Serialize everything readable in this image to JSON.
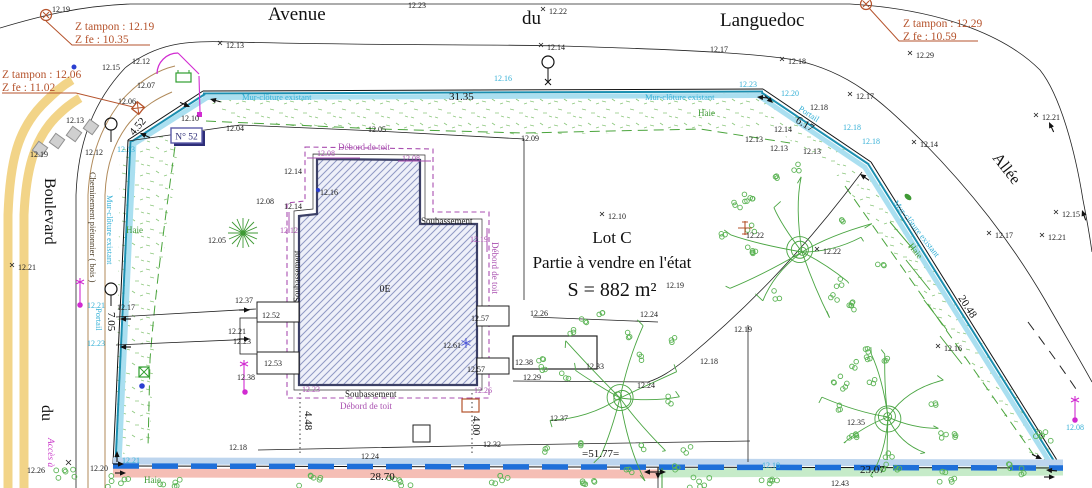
{
  "streets": {
    "avenue_w1": "Avenue",
    "avenue_w2": "du",
    "avenue_w3": "Languedoc",
    "boulevard_w1": "Boulevard",
    "boulevard_w2": "du",
    "allee": "Allée"
  },
  "lot": {
    "name": "Lot C",
    "desc": "Partie à vendre en l'état",
    "area": "S = 882 m²",
    "house_number": "N° 52",
    "floor": "0E"
  },
  "zbox": {
    "z1_l1": "Z tampon : 12.19",
    "z1_l2": "Z fe : 10.35",
    "z2_l1": "Z tampon : 12.06",
    "z2_l2": "Z fe : 11.02",
    "z3_l1": "Z tampon : 12.29",
    "z3_l2": "Z fe : 10.59"
  },
  "labels": {
    "mur": "Mur-clôture existant",
    "haie": "Haie",
    "portail": "Portail",
    "chemin": "Cheminement piétonnier ( bois )",
    "acces": "Accès à",
    "soubassement": "Soubassement",
    "debord": "Débord de toit"
  },
  "colors": {
    "rust": "#b5532c",
    "cyan_text": "#35b0d6",
    "wall_band": "#aadff0",
    "wall_edge": "#1b8fb0",
    "purple": "#a94fb0",
    "green": "#3f9a35",
    "tree_green": "#4aa542",
    "blue_dash": "#1e6fd9",
    "pink_band": "#f5beb5",
    "lightblue_band": "#bdd5ee",
    "green_band": "#c6ebc9",
    "yellow": "#f2d488",
    "magenta": "#d12bd1",
    "navy": "#2e2e78"
  },
  "points": [
    {
      "x": 52,
      "y": 12,
      "v": "12.19"
    },
    {
      "x": 408,
      "y": 8,
      "v": "12.23"
    },
    {
      "x": 549,
      "y": 14,
      "v": "12.22",
      "m": 1
    },
    {
      "x": 226,
      "y": 48,
      "v": "12.13",
      "m": 1
    },
    {
      "x": 547,
      "y": 50,
      "v": "12.14",
      "m": 1
    },
    {
      "x": 788,
      "y": 64,
      "v": "12.18",
      "m": 1
    },
    {
      "x": 856,
      "y": 99,
      "v": "12.17",
      "m": 1
    },
    {
      "x": 916,
      "y": 58,
      "v": "12.29",
      "m": 1
    },
    {
      "x": 710,
      "y": 52,
      "v": "12.17"
    },
    {
      "x": 1042,
      "y": 120,
      "v": "12.21",
      "m": 1
    },
    {
      "x": 1062,
      "y": 217,
      "v": "12.15",
      "m": 1
    },
    {
      "x": 995,
      "y": 238,
      "v": "12.17",
      "m": 1
    },
    {
      "x": 1048,
      "y": 240,
      "v": "12.21",
      "m": 1
    },
    {
      "x": 920,
      "y": 147,
      "v": "12.14",
      "m": 1
    },
    {
      "x": 102,
      "y": 70,
      "v": "12.15"
    },
    {
      "x": 132,
      "y": 64,
      "v": "12.12"
    },
    {
      "x": 137,
      "y": 88,
      "v": "12.07"
    },
    {
      "x": 118,
      "y": 104,
      "v": "12.06"
    },
    {
      "x": 66,
      "y": 123,
      "v": "12.13"
    },
    {
      "x": 30,
      "y": 157,
      "v": "12.19"
    },
    {
      "x": 85,
      "y": 155,
      "v": "12.12"
    },
    {
      "x": 226,
      "y": 131,
      "v": "12.04"
    },
    {
      "x": 181,
      "y": 121,
      "v": "12.10"
    },
    {
      "x": 368,
      "y": 132,
      "v": "12.05"
    },
    {
      "x": 521,
      "y": 141,
      "v": "12.09"
    },
    {
      "x": 608,
      "y": 219,
      "v": "12.10",
      "m": 1
    },
    {
      "x": 256,
      "y": 204,
      "v": "12.08"
    },
    {
      "x": 284,
      "y": 174,
      "v": "12.14"
    },
    {
      "x": 284,
      "y": 209,
      "v": "12.14"
    },
    {
      "x": 320,
      "y": 195,
      "v": "12.16"
    },
    {
      "x": 208,
      "y": 243,
      "v": "12.05"
    },
    {
      "x": 18,
      "y": 270,
      "v": "12.21",
      "m": 1
    },
    {
      "x": 117,
      "y": 310,
      "v": "12.17"
    },
    {
      "x": 235,
      "y": 303,
      "v": "12.37"
    },
    {
      "x": 262,
      "y": 318,
      "v": "12.52"
    },
    {
      "x": 228,
      "y": 334,
      "v": "12.21"
    },
    {
      "x": 233,
      "y": 344,
      "v": "12.23"
    },
    {
      "x": 264,
      "y": 366,
      "v": "12.53"
    },
    {
      "x": 237,
      "y": 380,
      "v": "12.38"
    },
    {
      "x": 666,
      "y": 288,
      "v": "12.19"
    },
    {
      "x": 530,
      "y": 316,
      "v": "12.26"
    },
    {
      "x": 640,
      "y": 317,
      "v": "12.24"
    },
    {
      "x": 515,
      "y": 365,
      "v": "12.38"
    },
    {
      "x": 586,
      "y": 369,
      "v": "12.33"
    },
    {
      "x": 523,
      "y": 380,
      "v": "12.29"
    },
    {
      "x": 700,
      "y": 364,
      "v": "12.18"
    },
    {
      "x": 637,
      "y": 388,
      "v": "12.24"
    },
    {
      "x": 550,
      "y": 421,
      "v": "12.37"
    },
    {
      "x": 734,
      "y": 332,
      "v": "12.19"
    },
    {
      "x": 746,
      "y": 238,
      "v": "12.22"
    },
    {
      "x": 823,
      "y": 254,
      "v": "12.22",
      "m": 1
    },
    {
      "x": 847,
      "y": 425,
      "v": "12.35"
    },
    {
      "x": 944,
      "y": 351,
      "v": "12.16",
      "m": 1
    },
    {
      "x": 483,
      "y": 447,
      "v": "12.32"
    },
    {
      "x": 361,
      "y": 459,
      "v": "12.24"
    },
    {
      "x": 229,
      "y": 450,
      "v": "12.18"
    },
    {
      "x": 831,
      "y": 486,
      "v": "12.43"
    },
    {
      "x": 443,
      "y": 348,
      "v": "12.61"
    },
    {
      "x": 471,
      "y": 321,
      "v": "12.57"
    },
    {
      "x": 467,
      "y": 372,
      "v": "12.57"
    },
    {
      "x": 90,
      "y": 471,
      "v": "12.20"
    },
    {
      "x": 27,
      "y": 473,
      "v": "12.26"
    },
    {
      "x": 745,
      "y": 142,
      "v": "12.13"
    },
    {
      "x": 770,
      "y": 151,
      "v": "12.13"
    },
    {
      "x": 803,
      "y": 154,
      "v": "12.13"
    },
    {
      "x": 774,
      "y": 132,
      "v": "12.14"
    },
    {
      "x": 810,
      "y": 110,
      "v": "12.18"
    },
    {
      "x": 494,
      "y": 81,
      "v": "12.16",
      "c": "c"
    },
    {
      "x": 739,
      "y": 87,
      "v": "12.23",
      "c": "c"
    },
    {
      "x": 781,
      "y": 96,
      "v": "12.20",
      "c": "c"
    },
    {
      "x": 843,
      "y": 130,
      "v": "12.18",
      "c": "c"
    },
    {
      "x": 862,
      "y": 144,
      "v": "12.18",
      "c": "c"
    },
    {
      "x": 117,
      "y": 152,
      "v": "12.13",
      "c": "c"
    },
    {
      "x": 87,
      "y": 308,
      "v": "12.21",
      "c": "c"
    },
    {
      "x": 87,
      "y": 346,
      "v": "12.23",
      "c": "c"
    },
    {
      "x": 122,
      "y": 463,
      "v": "12.21",
      "c": "c"
    },
    {
      "x": 762,
      "y": 468,
      "v": "12.18",
      "c": "c"
    },
    {
      "x": 1066,
      "y": 430,
      "v": "12.08",
      "c": "c"
    },
    {
      "x": 317,
      "y": 156,
      "v": "12.08",
      "c": "p"
    },
    {
      "x": 402,
      "y": 161,
      "v": "12.08",
      "c": "p"
    },
    {
      "x": 280,
      "y": 233,
      "v": "12.12",
      "c": "p"
    },
    {
      "x": 470,
      "y": 242,
      "v": "12.19",
      "c": "p"
    },
    {
      "x": 302,
      "y": 392,
      "v": "12.23",
      "c": "p"
    },
    {
      "x": 474,
      "y": 393,
      "v": "12.26",
      "c": "p"
    }
  ],
  "dims": [
    {
      "x": 449,
      "y": 100,
      "v": "31.35",
      "s": 13
    },
    {
      "x": 134,
      "y": 136,
      "v": "4.52",
      "r": -50
    },
    {
      "x": 795,
      "y": 122,
      "v": "6.17",
      "r": 31
    },
    {
      "x": 958,
      "y": 298,
      "v": "20.48",
      "r": 57
    },
    {
      "x": 108,
      "y": 312,
      "v": "7.05",
      "r": 90
    },
    {
      "x": 305,
      "y": 411,
      "v": "4.48",
      "r": 90
    },
    {
      "x": 473,
      "y": 416,
      "v": "4.00",
      "r": 90
    },
    {
      "x": 370,
      "y": 480,
      "v": "28.70",
      "s": 13.5
    },
    {
      "x": 582,
      "y": 457,
      "v": "=51.77=",
      "s": 12
    },
    {
      "x": 860,
      "y": 473,
      "v": "23.07",
      "s": 13.5
    }
  ],
  "figures": {
    "trees": [
      {
        "x": 620,
        "y": 398,
        "r": 92,
        "s": 7
      },
      {
        "x": 802,
        "y": 252,
        "r": 88,
        "s": 13
      },
      {
        "x": 888,
        "y": 417,
        "r": 75,
        "s": 21
      }
    ],
    "bushes": [
      {
        "x": 66,
        "y": 477,
        "r": 16
      },
      {
        "x": 118,
        "y": 481,
        "r": 12
      },
      {
        "x": 170,
        "y": 483,
        "r": 12
      },
      {
        "x": 310,
        "y": 481,
        "r": 11
      },
      {
        "x": 400,
        "y": 483,
        "r": 11
      },
      {
        "x": 500,
        "y": 481,
        "r": 12
      },
      {
        "x": 590,
        "y": 480,
        "r": 10
      },
      {
        "x": 700,
        "y": 482,
        "r": 11
      },
      {
        "x": 770,
        "y": 480,
        "r": 10
      },
      {
        "x": 950,
        "y": 477,
        "r": 11
      },
      {
        "x": 1020,
        "y": 470,
        "r": 12
      },
      {
        "x": 1042,
        "y": 437,
        "r": 10
      }
    ],
    "arrows": [
      {
        "x": 757,
        "y": 97,
        "a": 185
      },
      {
        "x": 773,
        "y": 103,
        "a": 42
      },
      {
        "x": 860,
        "y": 174,
        "a": 215
      },
      {
        "x": 210,
        "y": 99,
        "a": 195
      },
      {
        "x": 190,
        "y": 107,
        "a": 25
      },
      {
        "x": 140,
        "y": 133,
        "a": 205
      },
      {
        "x": 1042,
        "y": 459,
        "a": 25
      },
      {
        "x": 1046,
        "y": 470,
        "a": 185
      },
      {
        "x": 1055,
        "y": 477,
        "a": 0
      },
      {
        "x": 117,
        "y": 451,
        "a": 270
      },
      {
        "x": 124,
        "y": 464,
        "a": 0
      },
      {
        "x": 126,
        "y": 473,
        "a": 0
      },
      {
        "x": 644,
        "y": 472,
        "a": 180
      },
      {
        "x": 666,
        "y": 472,
        "a": 0
      },
      {
        "x": 658,
        "y": 479,
        "a": 90
      },
      {
        "x": 250,
        "y": 310,
        "a": 0
      },
      {
        "x": 250,
        "y": 339,
        "a": 0
      },
      {
        "x": 120,
        "y": 319,
        "a": 180
      },
      {
        "x": 120,
        "y": 347,
        "a": 180
      },
      {
        "x": 1049,
        "y": 122,
        "a": 245
      },
      {
        "x": 1082,
        "y": 210,
        "a": 250
      }
    ],
    "pavers": [
      {
        "x": 40,
        "y": 149
      },
      {
        "x": 57,
        "y": 141
      },
      {
        "x": 74,
        "y": 134
      },
      {
        "x": 91,
        "y": 127
      }
    ]
  }
}
